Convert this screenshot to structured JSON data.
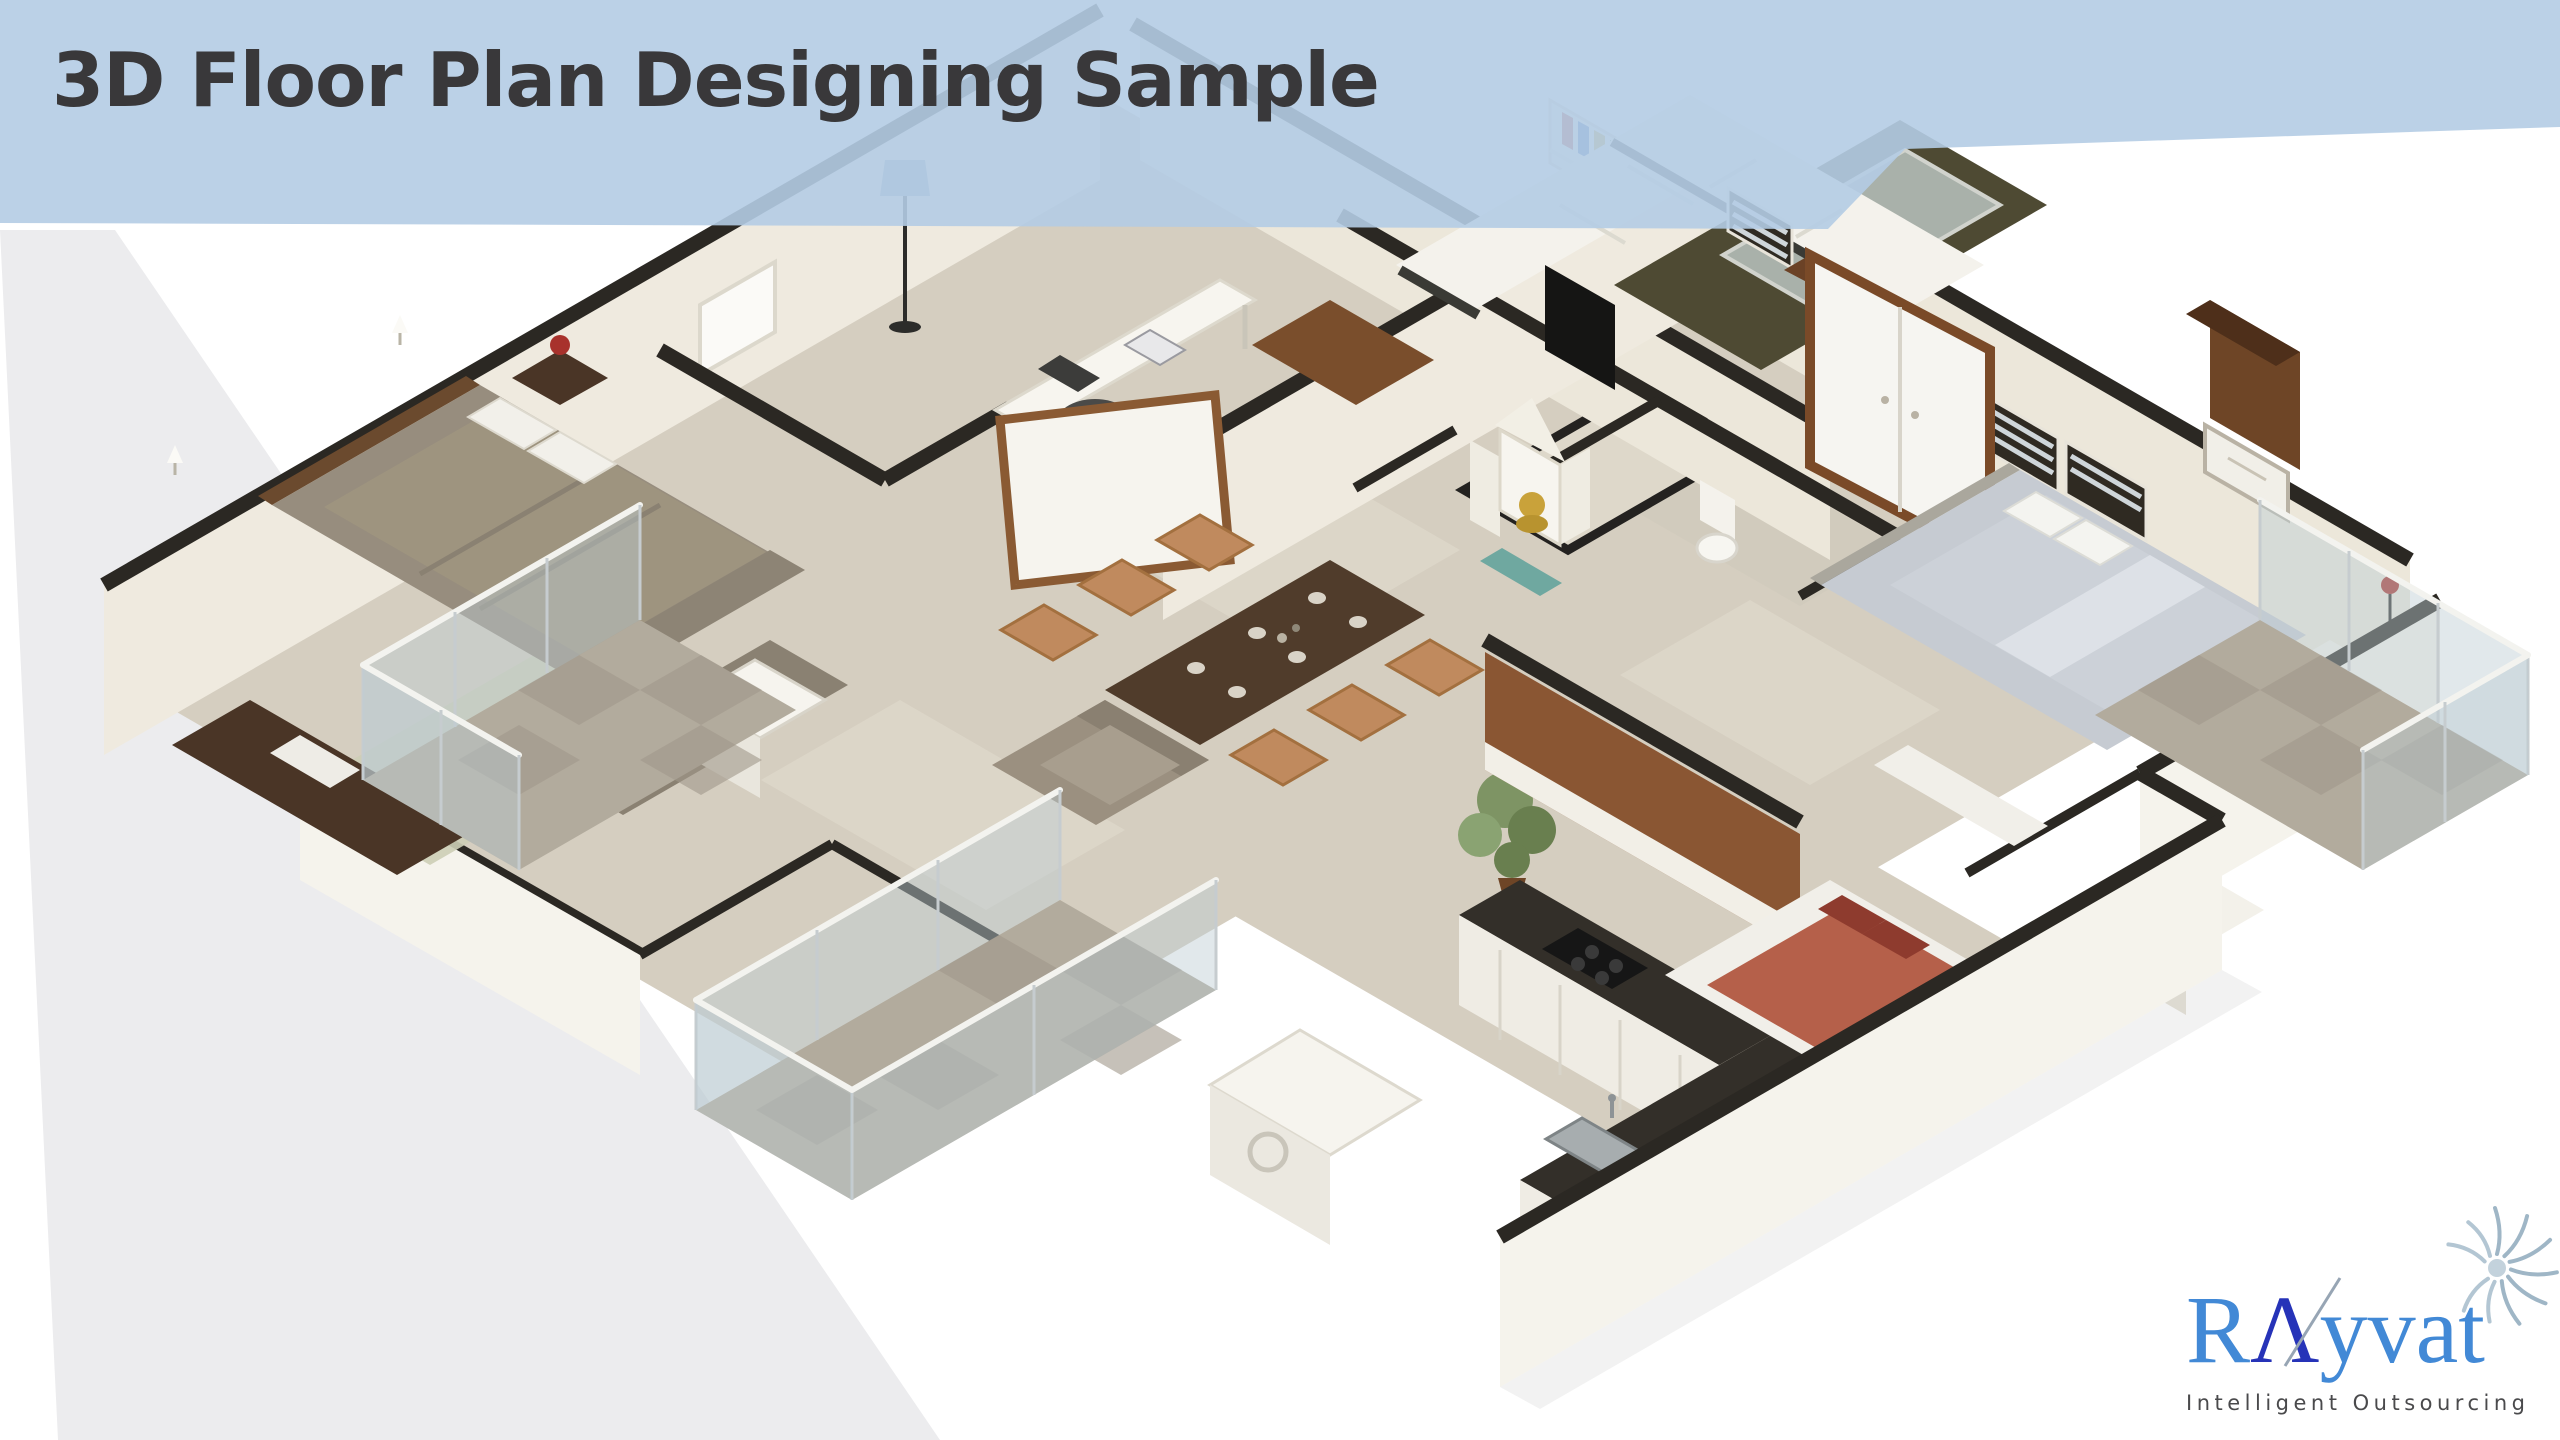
{
  "banner": {
    "title": "3D Floor Plan Designing Sample",
    "background_color": "#b4cce4",
    "text_color": "#39383a"
  },
  "logo": {
    "brand": "RAyvat",
    "brand_r": "R",
    "brand_a": "Λ",
    "brand_rest": "yvat",
    "tagline": "Intelligent Outsourcing",
    "brand_light_blue": "#4289d6",
    "brand_navy": "#2633b8",
    "tagline_color": "#4a4a4c",
    "fern_icon_color": "#9fb6c6"
  },
  "scene": {
    "background_color": "#ffffff",
    "side_panel_color": "#ececee",
    "floor_color": "#d5cec0",
    "wall_cap_color": "#2b2823",
    "wall_face_color": "#efeadf",
    "balcony_tile_color": "#b2ab9d",
    "glass_railing_color": "#bccbd3",
    "rooms": [
      {
        "name": "master-bedroom",
        "key_colors": {
          "bed": "#978d7e",
          "headboard": "#6b4a2e",
          "rug": "#cdceb6",
          "wardrobe": "#4a3526",
          "lamp": "#a8322c"
        }
      },
      {
        "name": "living-room",
        "key_colors": {
          "sofa": "#f3f2ed",
          "sofa_trim": "#3a3a35",
          "rug": "#4e4a33",
          "coffee_table_glass": "#b9c4bf",
          "tv": "#151514",
          "bookshelf_books": [
            "#b33a2f",
            "#2f5fae",
            "#caa52c",
            "#3e7a3a",
            "#7a3a8a",
            "#c46a2a",
            "#274b77",
            "#a0a0a0"
          ]
        }
      },
      {
        "name": "study-corner",
        "key_colors": {
          "desk": "#f7f5ef",
          "chair": "#4a4a48",
          "sideboard": "#7a4e2c"
        }
      },
      {
        "name": "dining-area",
        "key_colors": {
          "table": "#503c2b",
          "chairs": "#c08a5e",
          "plates": "#d9d3c7",
          "plant": "#7e9464"
        }
      },
      {
        "name": "pooja-room",
        "key_colors": {
          "shrine": "#f7f5ef",
          "idol": "#c9a23a",
          "mat": "#6fa8a0"
        }
      },
      {
        "name": "bathroom",
        "key_colors": {
          "toilet": "#f7f6f1",
          "louver_window": "#2f2a22"
        }
      },
      {
        "name": "wardrobe-unit",
        "key_colors": {
          "doors": "#f6f5f1",
          "frame": "#7a4a28"
        }
      },
      {
        "name": "bedroom-2",
        "key_colors": {
          "bed": "#c6cbd2",
          "pillows": "#f4f4f0",
          "bench": "#f1efe9"
        }
      },
      {
        "name": "bedroom-3",
        "key_colors": {
          "bed_frame": "#f1efe9",
          "blanket": "#b5604a",
          "pillows": "#8e3b2e"
        }
      },
      {
        "name": "kitchen",
        "key_colors": {
          "counter": "#332f29",
          "cabinets": "#efece4",
          "hob": "#161616",
          "sink": "#a7adaf"
        }
      },
      {
        "name": "balconies",
        "key_colors": {
          "tiles": "#b2ab9d",
          "glass": "#bccbd3",
          "rail": "#f3f3ef"
        }
      }
    ]
  }
}
